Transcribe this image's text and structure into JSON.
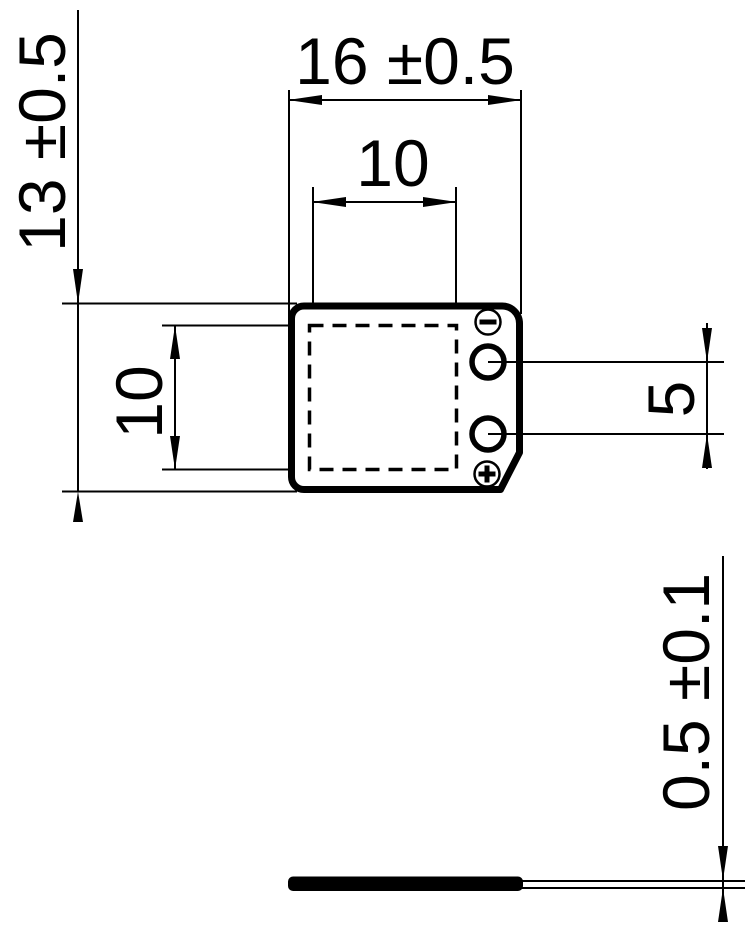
{
  "dimensions": {
    "body_width": {
      "label": "16 ±0.5"
    },
    "element_width": {
      "label": "10"
    },
    "body_height": {
      "label": "13 ±0.5"
    },
    "element_height": {
      "label": "10"
    },
    "terminal_spacing": {
      "label": "5"
    },
    "thickness": {
      "label": "0.5 ±0.1"
    }
  },
  "polarity": {
    "negative": "−",
    "positive": "+"
  },
  "colors": {
    "line": "#000000",
    "background": "#ffffff"
  }
}
